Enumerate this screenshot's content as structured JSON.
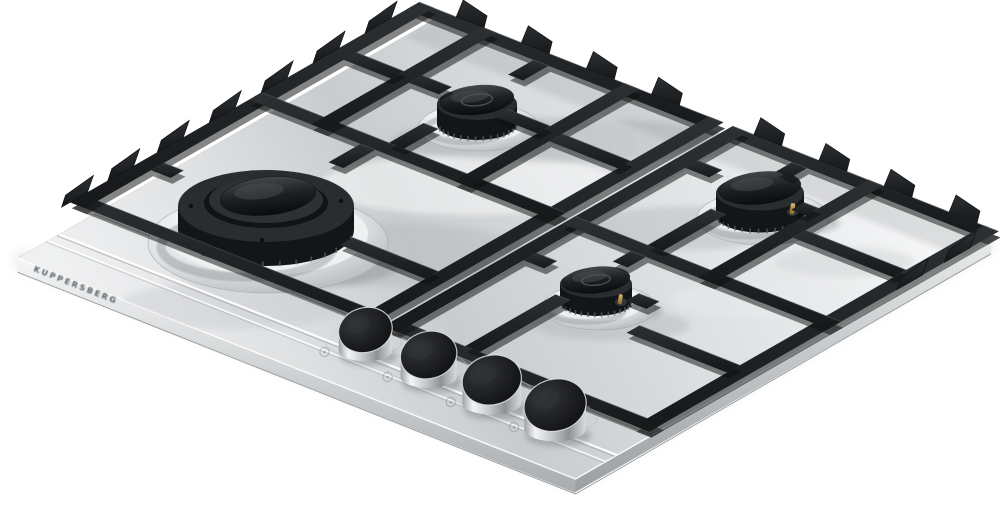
{
  "scene": {
    "type": "product-photo",
    "subject": "Built-in 4-burner stainless steel gas hob with black cast-iron pan supports",
    "background_color": "#ffffff",
    "embossed_brand": "KUPPERSBERG",
    "colors": {
      "steel_highlight": "#f7f8f9",
      "steel_mid": "#d5d8da",
      "steel_shadow": "#9b9ea1",
      "grate_black": "#1d2022",
      "grate_shadow": "#0b0c0d",
      "burner_cap_black": "#141618",
      "knob_top_black": "#121314",
      "igniter_brass": "#b08d4a"
    },
    "burners": [
      {
        "id": "wok",
        "label": "large wok burner",
        "screen_position": "center-left"
      },
      {
        "id": "semi-rear",
        "label": "medium burner",
        "screen_position": "top-center"
      },
      {
        "id": "rapid",
        "label": "medium burner",
        "screen_position": "right"
      },
      {
        "id": "auxiliary",
        "label": "small burner",
        "screen_position": "bottom-center"
      }
    ],
    "knobs": [
      {
        "id": "knob-1"
      },
      {
        "id": "knob-2"
      },
      {
        "id": "knob-3"
      },
      {
        "id": "knob-4"
      }
    ],
    "pan_supports": {
      "sections": 2,
      "finish": "matte black cast iron"
    }
  }
}
